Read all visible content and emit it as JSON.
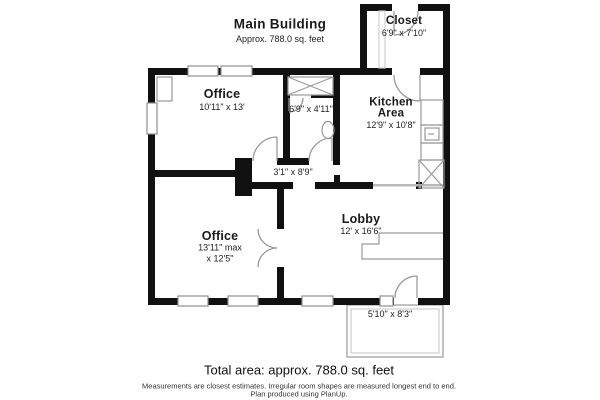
{
  "header": {
    "title": "Main Building",
    "subtitle": "Approx. 788.0 sq. feet"
  },
  "rooms": {
    "closet": {
      "name": "Closet",
      "dims": "6'9\" x 7'10\""
    },
    "office_top": {
      "name": "Office",
      "dims": "10'11\" x 13'"
    },
    "bathroom": {
      "dims": "6'9\" x 4'11\""
    },
    "kitchen": {
      "line1": "Kitchen",
      "line2": "Area",
      "dims": "12'9\" x 10'8\""
    },
    "hallway": {
      "dims": "3'1\" x 8'9\""
    },
    "office_bottom": {
      "name": "Office",
      "dims_line1": "13'11\" max",
      "dims_line2": "x 12'5\""
    },
    "lobby": {
      "name": "Lobby",
      "dims": "12' x 16'6\""
    },
    "porch": {
      "dims": "5'10\" x 8'3\""
    }
  },
  "footer": {
    "total": "Total area: approx. 788.0 sq. feet",
    "disclaimer1": "Measurements are closest estimates. Irregular room shapes are measured longest end to end.",
    "disclaimer2": "Plan produced using PlanUp."
  },
  "colors": {
    "wall": "#111111",
    "fixture": "#9a9a9a",
    "text": "#1a1a1a"
  }
}
